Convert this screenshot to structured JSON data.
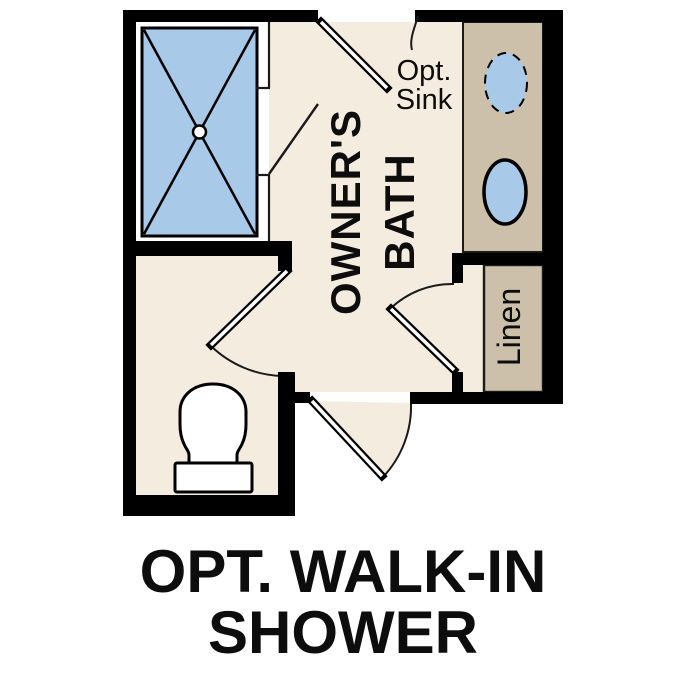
{
  "caption": {
    "line1": "OPT. WALK-IN",
    "line2": "SHOWER"
  },
  "labels": {
    "room_line1": "OWNER'S",
    "room_line2": "BATH",
    "linen": "Linen",
    "opt_sink_line1": "Opt.",
    "opt_sink_line2": "Sink"
  },
  "icons": [
    "walk-in-shower-pan-icon",
    "shower-drain-icon",
    "shower-door-icon",
    "optional-sink-icon",
    "sink-icon",
    "toilet-icon",
    "door-swing-icon",
    "linen-closet"
  ],
  "colors": {
    "bg": "#ffffff",
    "floor": "#f4eddf",
    "counter": "#ccc0aa",
    "water": "#a9c9e9",
    "wall": "#000000",
    "line": "#1a1a1a",
    "text": "#0d0d0d"
  }
}
